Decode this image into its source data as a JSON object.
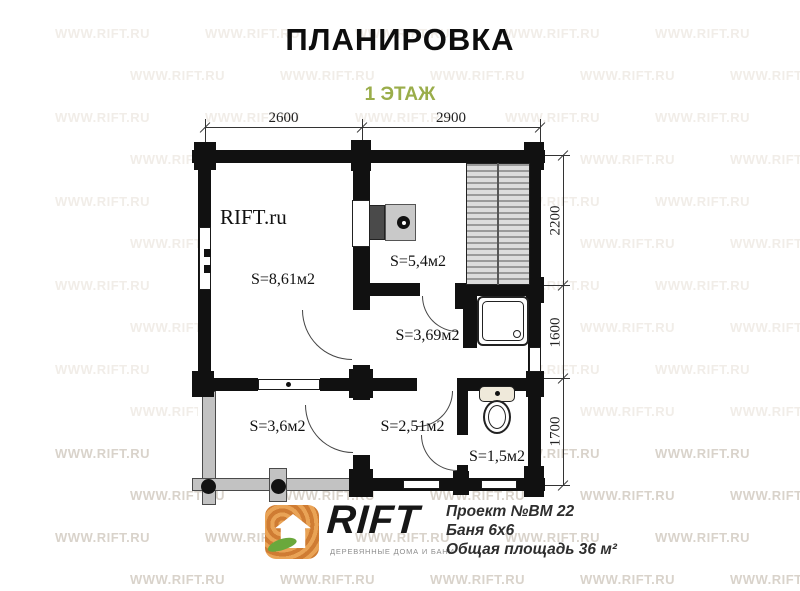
{
  "title": "ПЛАНИРОВКА",
  "subtitle": "1 ЭТАЖ",
  "colors": {
    "subtitle_green": "#9aad4a",
    "wall_black": "#111111",
    "terrace_gray": "#c2c2c2",
    "logo_orange": "#cf7c33",
    "leaf_green": "#6aa83c",
    "watermark_faint": "#f1ede8",
    "watermark_strong": "#d9d3cb"
  },
  "watermark": {
    "text": "WWW.RIFT.RU"
  },
  "plan": {
    "inner_brand_label": "RIFT.ru",
    "rooms": [
      {
        "name": "rest-room",
        "area_label": "S=8,61м2"
      },
      {
        "name": "sauna",
        "area_label": "S=5,4м2"
      },
      {
        "name": "washroom",
        "area_label": "S=3,69м2"
      },
      {
        "name": "terrace",
        "area_label": "S=3,6м2"
      },
      {
        "name": "hallway",
        "area_label": "S=2,51м2"
      },
      {
        "name": "wc",
        "area_label": "S=1,5м2"
      }
    ],
    "dimensions": {
      "top": [
        "2600",
        "2900"
      ],
      "right": [
        "2200",
        "1600",
        "1700"
      ]
    }
  },
  "footer": {
    "logo_text": "RIFT",
    "logo_tagline": "ДЕРЕВЯННЫЕ ДОМА И БАНИ",
    "project_lines": [
      "Проект №ВМ 22",
      "Баня 6х6",
      "Общая площадь 36 м²"
    ]
  }
}
